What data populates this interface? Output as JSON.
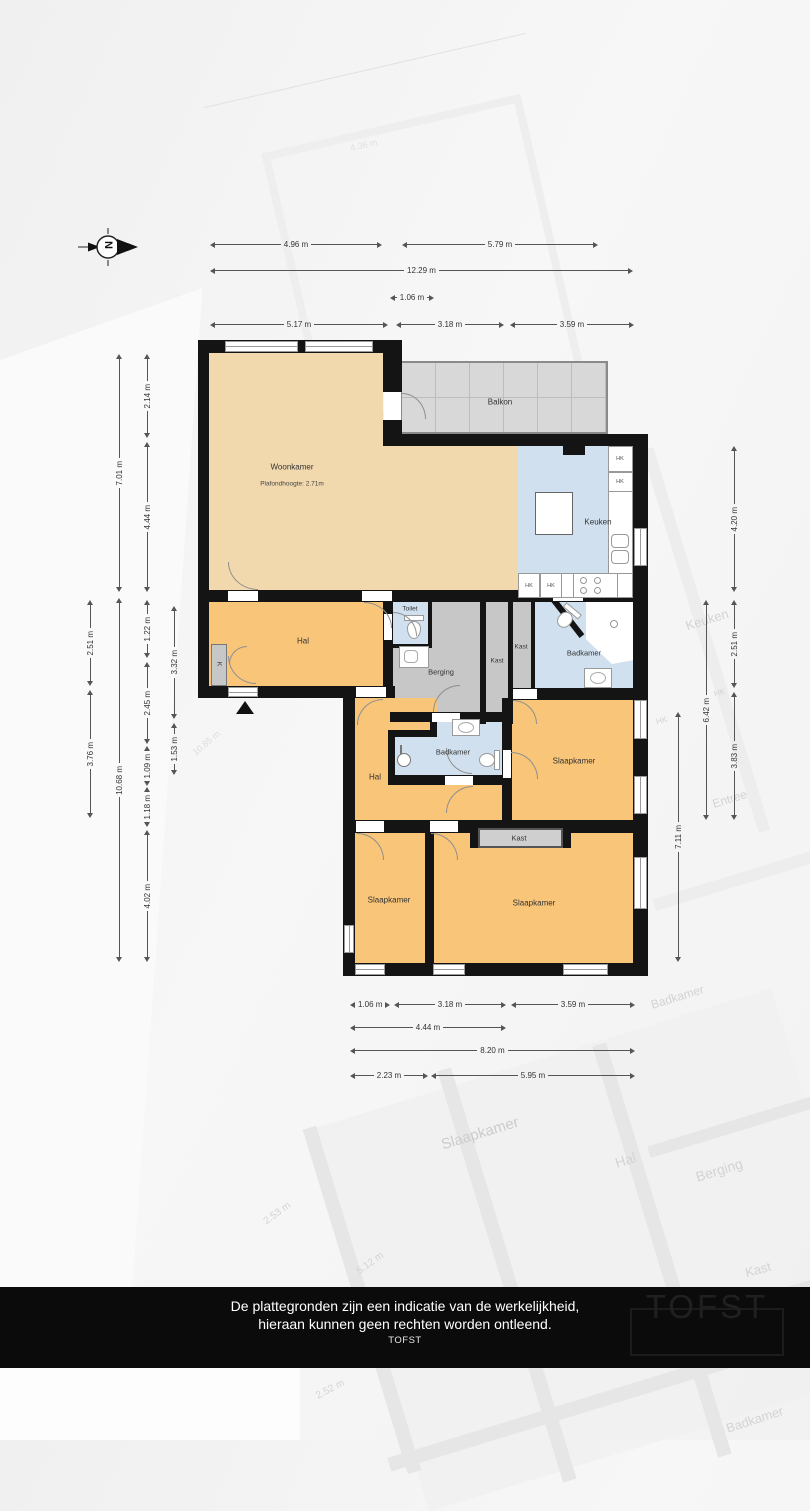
{
  "compass": {
    "letter": "N"
  },
  "plan": {
    "rooms": [
      {
        "label": "Woonkamer",
        "sublabel": "Plafondhoogte: 2.71m"
      },
      {
        "label": "Balkon"
      },
      {
        "label": "Keuken"
      },
      {
        "label": "Toilet"
      },
      {
        "label": "Hal"
      },
      {
        "label": "K"
      },
      {
        "label": "Berging"
      },
      {
        "label": "Kast"
      },
      {
        "label": "Kast"
      },
      {
        "label": "Badkamer"
      },
      {
        "label": "Slaapkamer"
      },
      {
        "label": "Badkamer"
      },
      {
        "label": "Hal"
      },
      {
        "label": "Kast"
      },
      {
        "label": "Slaapkamer"
      },
      {
        "label": "Slaapkamer"
      }
    ],
    "cabinet_labels": [
      "HK",
      "HK",
      "HK",
      "HK"
    ]
  },
  "dimensions": {
    "top": {
      "row1": [
        "4.96 m",
        "5.79 m"
      ],
      "row2": [
        "12.29 m"
      ],
      "row3": [
        "1.06 m"
      ],
      "row4": [
        "5.17 m",
        "3.18 m",
        "3.59 m"
      ]
    },
    "left": {
      "col1": [
        "2.51 m",
        "3.76 m"
      ],
      "col2": [
        "7.01 m",
        "10.68 m"
      ],
      "col3": [
        "2.14 m",
        "4.44 m",
        "1.22 m",
        "2.45 m",
        "1.09 m",
        "1.18 m",
        "4.02 m"
      ],
      "col4": [
        "3.32 m",
        "1.53 m"
      ]
    },
    "right": {
      "col1": [
        "4.20 m",
        "2.51 m",
        "3.83 m"
      ],
      "col2": [
        "6.42 m"
      ],
      "col3": [
        "7.11 m"
      ]
    },
    "bottom": {
      "row1": [
        "1.06 m",
        "3.18 m",
        "3.59 m"
      ],
      "row2": [
        "4.44 m"
      ],
      "row3": [
        "8.20 m"
      ],
      "row4": [
        "2.23 m",
        "5.95 m"
      ]
    }
  },
  "watermark": {
    "labels": [
      "Keuken",
      "HK",
      "HK",
      "Entree",
      "Badkamer",
      "Slaapkamer",
      "Hal",
      "Berging",
      "Kast",
      "Badkamer"
    ],
    "dims": [
      "2.53 m",
      "5.12 m",
      "2.52 m",
      "10.85 m",
      "4.36 m"
    ]
  },
  "footer": {
    "line1": "De plattegronden zijn een indicatie van de werkelijkheid,",
    "line2": "hieraan kunnen geen rechten worden ontleend.",
    "line3": "TOFST",
    "logo": "TOFST"
  },
  "colors": {
    "room_living": "#f1d9ad",
    "room_hall": "#f8c579",
    "room_wet": "#d0e0ef",
    "room_storage": "#c7c7c7",
    "balcony": "#d8d8d8",
    "wall": "#141414"
  }
}
